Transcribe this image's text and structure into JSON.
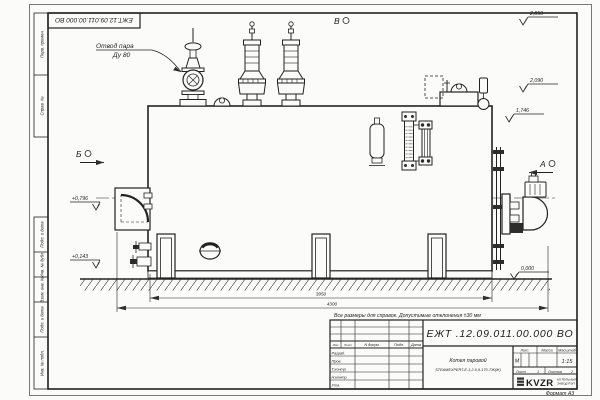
{
  "sheet": {
    "doc_number": "ЕЖТ.12.09.011.00.000 ВО",
    "reference_note": "Все размеры для справок. Допустимые отклонения ±30 мм",
    "format_note": "Формат А3"
  },
  "annotations": {
    "steam_outlet_line1": "Отвод пара",
    "steam_outlet_line2": "Ду 80",
    "view_top": "В",
    "view_left": "Б",
    "view_right": "А"
  },
  "elevations": {
    "valve_top": "2,850",
    "drum_top": "2,090",
    "shell_top": "1,746",
    "ground": "0,000",
    "front_mid": "+0,796",
    "front_low": "+0,143"
  },
  "dimensions": {
    "shell_length": "3950",
    "overall_length": "4300"
  },
  "title_block": {
    "doc_number": "ЕЖТ .12.09.011.00.000  ВО",
    "product_line1": "Котел паровой",
    "product_line2": "STEAMEXPERT-Е-1,2-0,9-170-ТЖ(Ж)",
    "header_cols": [
      "Изм",
      "Лист",
      "N докум.",
      "Подп.",
      "Дата"
    ],
    "sign_rows": [
      "Разраб.",
      "Пров.",
      "Т.контр.",
      "Н.контр.",
      "Утв."
    ],
    "lit_label": "Лит.",
    "lit_value": "М",
    "mass_label": "Масса",
    "scale_label": "Масштаб",
    "scale_value": "1:15",
    "sheet_label": "Лист",
    "sheet_value": "1",
    "sheets_label": "Листов",
    "sheets_value": "2",
    "logo_text": "KVZR",
    "logo_sub1": "КОТЕЛЬНЫЙ",
    "logo_sub2": "ЗАВОД РЭП"
  },
  "margin_column": {
    "cells": [
      "Перв. примен.",
      "Справ. №",
      "Подп. и дата",
      "Инв. № дубл.",
      "Взам. инв. №",
      "Подп. и дата",
      "Инв. № подл."
    ]
  }
}
